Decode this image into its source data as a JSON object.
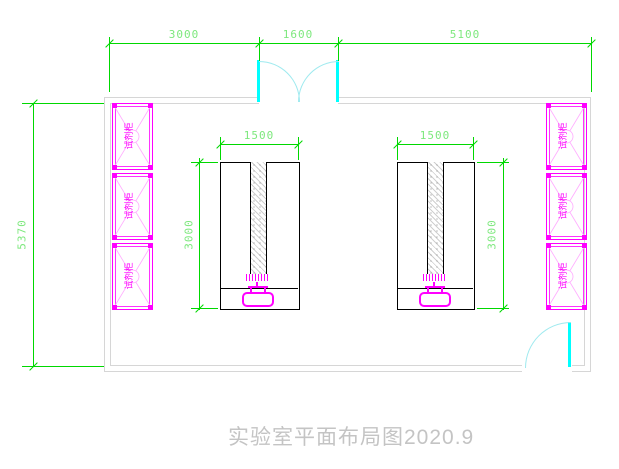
{
  "drawing_title": "实验室平面布局图2020.9",
  "room": {
    "top_dimensions": [
      "3000",
      "1600",
      "5100"
    ],
    "left_dimension": "5370"
  },
  "benches": {
    "count": 2,
    "width_dimension": "1500",
    "depth_dimension": "3000"
  },
  "cabinets": {
    "label": "试剂柜",
    "left_column_count": 3,
    "right_column_count": 3
  },
  "doors": {
    "top": "double",
    "bottom_right": "single"
  },
  "colors": {
    "dimension_green": "#00d800",
    "dimension_text_green": "#7de87d",
    "cabinet_magenta": "#ff00ff",
    "door_cyan": "#00ffff",
    "wall_gray": "#d6d6d6",
    "bench_black": "#000000",
    "title_gray": "#c4c4c4"
  }
}
